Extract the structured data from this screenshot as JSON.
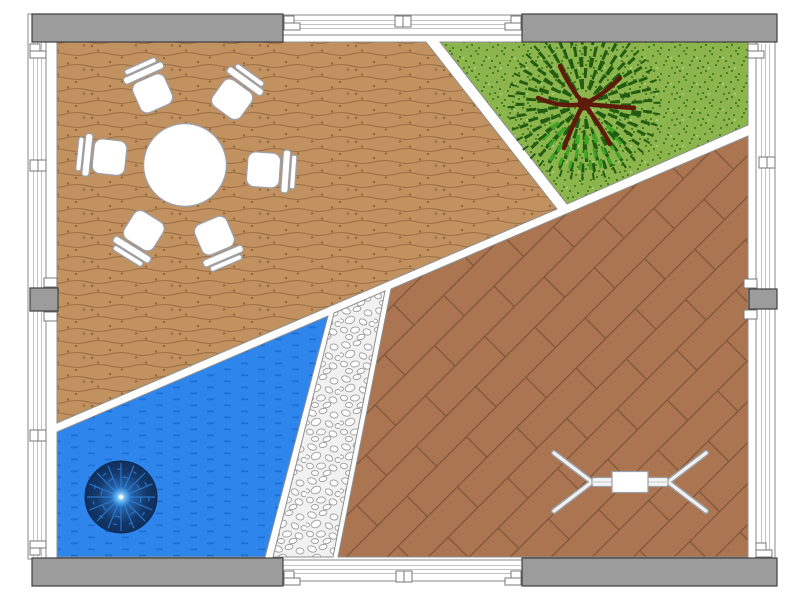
{
  "canvas": {
    "width": 800,
    "height": 600,
    "background": "#FFFFFF",
    "kind": "patio-garden-plan"
  },
  "palette": {
    "wall-gray": "#9C9C9C",
    "wall-stroke": "#3F3F3F",
    "fence-white": "#FFFFFF",
    "fence-line": "#C2C2C2",
    "edge-gray": "#8F8F8F",
    "deck": "#C29160",
    "deck-line": "#9A7045",
    "deck-dot": "#8B6434",
    "grass": "#8CB54D",
    "grass-dark": "#47821F",
    "grass-light": "#AACB70",
    "pool": "#2E86EC",
    "pool-dash": "#1D6FD6",
    "pool-light-ray": "#2E7FD6",
    "gravel-bg": "#F1F1F1",
    "pebble": "#FFFFFF",
    "pebble-stroke": "#9C9C9C",
    "paving": "#AC7551",
    "paving-line": "#7E5638",
    "trunk": "#5E1A0A",
    "foliage-dark": "#215C10",
    "foliage-light": "#3FA524",
    "furniture-fill": "#FFFFFF",
    "furniture-stroke": "#9E9EA3",
    "bench-metal": "#F2F2F2",
    "bench-stroke": "#9AA0A6"
  },
  "regions": [
    {
      "id": "deck",
      "name": "wood-deck",
      "texture": "wavy-planks"
    },
    {
      "id": "lawn",
      "name": "grass-lawn",
      "texture": "speckles"
    },
    {
      "id": "pool",
      "name": "swimming-pool",
      "texture": "water-dashes"
    },
    {
      "id": "gravel",
      "name": "gravel-path",
      "texture": "pebbles"
    },
    {
      "id": "patio",
      "name": "paved-patio",
      "texture": "diagonal-planks"
    }
  ],
  "furniture": {
    "table": {
      "type": "round-dining-table",
      "transform": "translate(185,165)"
    },
    "chairs": [
      {
        "type": "armchair",
        "transform": "translate(152,92) rotate(-24)"
      },
      {
        "type": "armchair",
        "transform": "translate(233,98) rotate(36)"
      },
      {
        "type": "armchair",
        "transform": "translate(108,157) rotate(-84)"
      },
      {
        "type": "armchair",
        "transform": "translate(265,170) rotate(94)"
      },
      {
        "type": "armchair",
        "transform": "translate(143,232) rotate(212)"
      },
      {
        "type": "armchair",
        "transform": "translate(215,237) rotate(157)"
      }
    ],
    "tree": {
      "type": "deciduous-tree",
      "transform": "translate(584,104)"
    },
    "pool_light": {
      "type": "pool-fountain-light",
      "transform": "translate(121,497)"
    },
    "bench": {
      "type": "metal-glider-bench",
      "transform": "translate(630,482)"
    }
  },
  "perimeter": {
    "gray_wall_segments": 4,
    "fence_panels": 4,
    "mid_wall_posts": 2,
    "connector_symbols": 5
  }
}
